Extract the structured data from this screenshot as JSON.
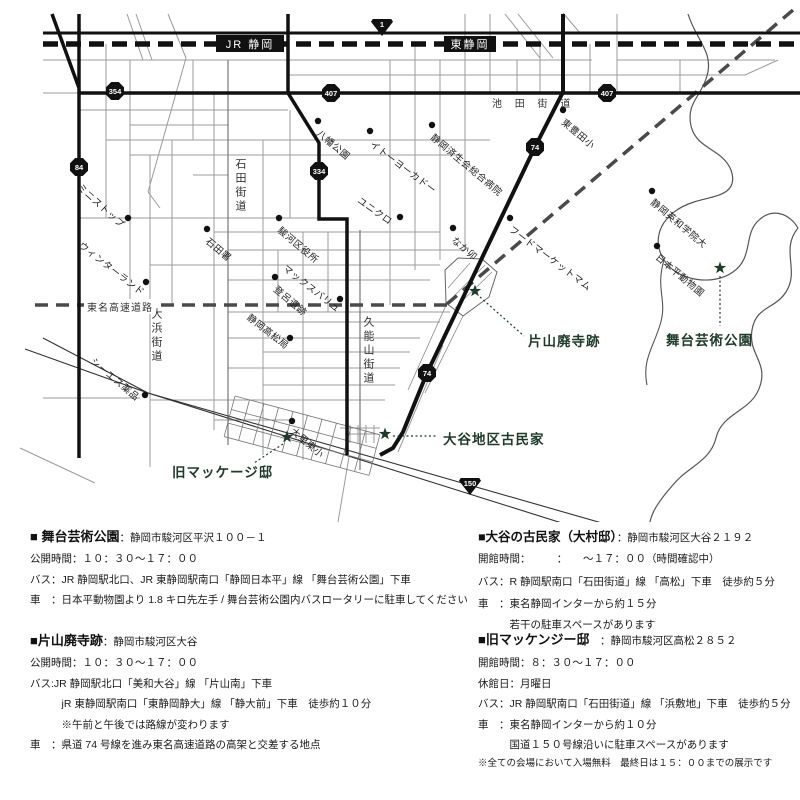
{
  "colors": {
    "accent_green": "#1f3a2a",
    "road_black": "#111111",
    "street_gray": "#9b9b9b",
    "expressway_gray": "#4a4a4a"
  },
  "map": {
    "stations": [
      {
        "label": "JR 静岡"
      },
      {
        "label": "東静岡"
      }
    ],
    "shields": [
      {
        "label": "1"
      },
      {
        "label": "354"
      },
      {
        "label": "407"
      },
      {
        "label": "407"
      },
      {
        "label": "84"
      },
      {
        "label": "334"
      },
      {
        "label": "74"
      },
      {
        "label": "74"
      },
      {
        "label": "150"
      }
    ],
    "roads": {
      "ikeda": "池 田 街 道",
      "ishida": "石田街道",
      "ohama": "大浜街道",
      "kunozan": "久能山街道",
      "tomei": "東名高速道路"
    },
    "pois": [
      {
        "name": "八幡公園"
      },
      {
        "name": "イトーヨーカドー"
      },
      {
        "name": "静岡済生会総合病院"
      },
      {
        "name": "東豊田小"
      },
      {
        "name": "ユニクロ"
      },
      {
        "name": "なか卯"
      },
      {
        "name": "ミニストップ"
      },
      {
        "name": "ウィンターランド"
      },
      {
        "name": "石田署"
      },
      {
        "name": "駿河区役所"
      },
      {
        "name": "マックスバリュ"
      },
      {
        "name": "登呂遺跡"
      },
      {
        "name": "静岡高松局"
      },
      {
        "name": "シーエス薬品"
      },
      {
        "name": "大里東小"
      },
      {
        "name": "フードマーケットマム"
      },
      {
        "name": "静岡英和学院大"
      },
      {
        "name": "日本平動物園"
      }
    ],
    "destinations": [
      {
        "name": "片山廃寺跡"
      },
      {
        "name": "舞台芸術公園"
      },
      {
        "name": "大谷地区古民家"
      },
      {
        "name": "旧マッケージ邸"
      }
    ]
  },
  "info": {
    "blocks": [
      {
        "title": "■ 舞台芸術公園",
        "address": "：静岡市駿河区平沢１００－１",
        "lines": [
          "公開時間：１０：３０～１７：００",
          "バス：JR 静岡駅北口、JR 東静岡駅南口「静岡日本平」線 「舞台芸術公園」下車",
          "車　：日本平動物園より 1.8 キロ先左手 / 舞台芸術公園内バスロータリーに駐車してください"
        ]
      },
      {
        "title": "■片山廃寺跡",
        "address": "：静岡市駿河区大谷",
        "lines": [
          "公開時間：１０：３０～１７：００",
          "バス:JR 静岡駅北口「美和大谷」線 「片山南」下車",
          "　　　jR 東静岡駅南口「東静岡静大」線 「静大前」下車　徒歩約１０分",
          "　　　※午前と午後では路線が変わります",
          "車　：県道 74 号線を進み東名高速道路の高架と交差する地点"
        ]
      },
      {
        "title": "■大谷の古民家（大村邸）",
        "address": "：静岡市駿河区大谷２１９２",
        "lines": [
          "開館時間：　　　：　　～１７：００（時間確認中）",
          "バス：R 静岡駅南口「石田街道」線 「高松」下車　徒歩約５分",
          "車　：東名静岡インターから約１５分",
          "　　　若干の駐車スペースがあります"
        ]
      },
      {
        "title": "■旧マッケンジー邸",
        "address": "　：静岡市駿河区高松２８５２",
        "lines": [
          "開館時間：８：３０～１７：００",
          "休館日：月曜日",
          "バス：JR 静岡駅南口「石田街道」線 「浜敷地」下車　徒歩約５分",
          "車　：東名静岡インターから約１０分",
          "　　　国道１５０号線沿いに駐車スペースがあります"
        ]
      }
    ],
    "footer": "※全ての会場において入場無料　最終日は１５：００までの展示です"
  }
}
